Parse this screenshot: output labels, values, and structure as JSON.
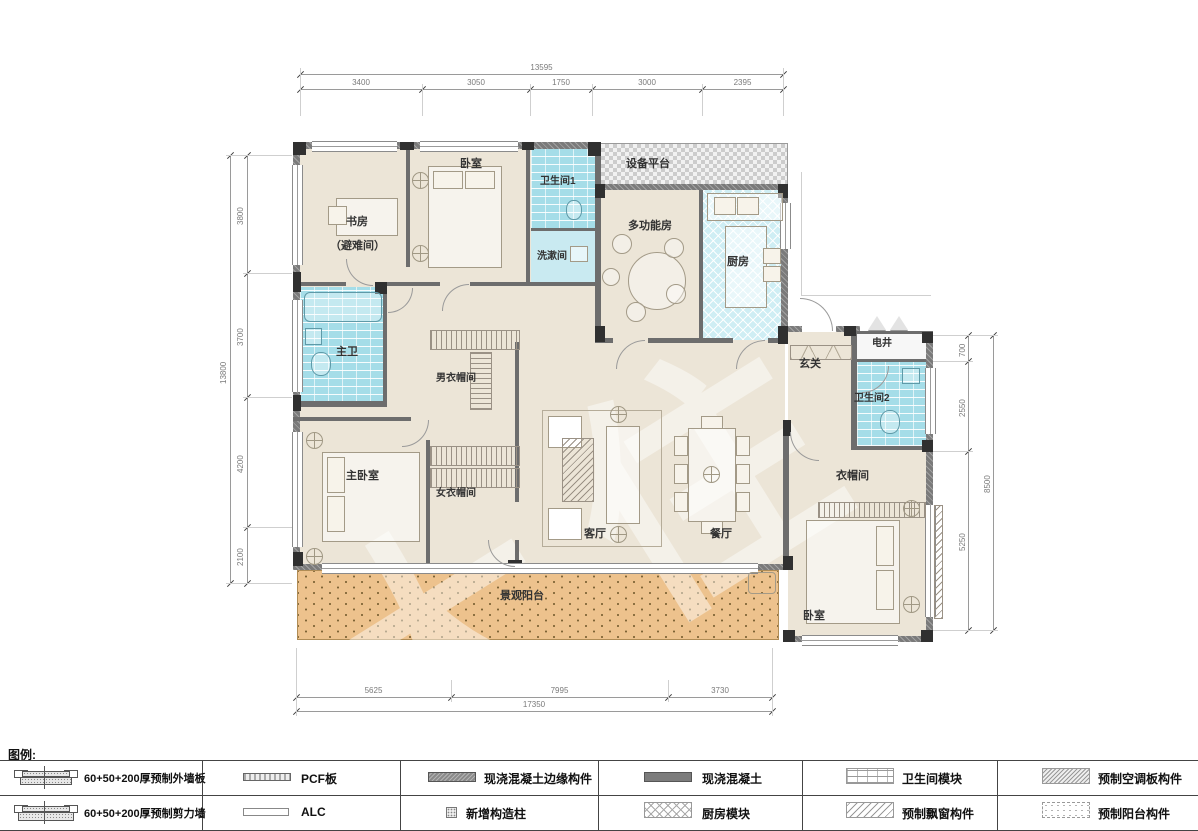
{
  "plan": {
    "watermark": "大住",
    "rooms": [
      {
        "id": "study",
        "label": "书房",
        "sublabel": "（避难间）"
      },
      {
        "id": "bedroom-top",
        "label": "卧室"
      },
      {
        "id": "bath-1",
        "label": "卫生间1"
      },
      {
        "id": "washroom",
        "label": "洗漱间"
      },
      {
        "id": "equipment-platform",
        "label": "设备平台"
      },
      {
        "id": "multifunction-room",
        "label": "多功能房"
      },
      {
        "id": "kitchen",
        "label": "厨房"
      },
      {
        "id": "master-bath",
        "label": "主卫"
      },
      {
        "id": "mens-closet",
        "label": "男衣帽间"
      },
      {
        "id": "master-bedroom",
        "label": "主卧室"
      },
      {
        "id": "womens-closet",
        "label": "女衣帽间"
      },
      {
        "id": "living-room",
        "label": "客厅"
      },
      {
        "id": "dining-room",
        "label": "餐厅"
      },
      {
        "id": "foyer",
        "label": "玄关"
      },
      {
        "id": "electric-shaft",
        "label": "电井"
      },
      {
        "id": "bath-2",
        "label": "卫生间2"
      },
      {
        "id": "closet",
        "label": "衣帽间"
      },
      {
        "id": "bedroom-br",
        "label": "卧室"
      },
      {
        "id": "balcony",
        "label": "景观阳台"
      }
    ],
    "dims": {
      "top": {
        "overall": "13595",
        "segments": [
          "3400",
          "3050",
          "1750",
          "3000",
          "2395"
        ]
      },
      "left": {
        "overall": "13800",
        "segments": [
          "3800",
          "3700",
          "4200",
          "2100"
        ]
      },
      "right": {
        "overall": "8500",
        "segments": [
          "700",
          "2550",
          "5250"
        ]
      },
      "bottom": {
        "overall": "17350",
        "segments": [
          "5625",
          "7995",
          "3730"
        ]
      }
    },
    "colors": {
      "floor": "#ece5d7",
      "bath_module": "#a5dde8",
      "kitchen_module": "#cfeef4",
      "balcony": "#edc28d",
      "wall": "#6d6d6d",
      "concrete_column": "#303030"
    }
  },
  "legend": {
    "title": "图例:",
    "items": [
      {
        "symbol": "precast-exterior-wall",
        "label": "60+50+200厚预制外墙板"
      },
      {
        "symbol": "precast-shear-wall",
        "label": "60+50+200厚预制剪力墙"
      },
      {
        "symbol": "pcf-panel",
        "label": "PCF板"
      },
      {
        "symbol": "alc-panel",
        "label": "ALC"
      },
      {
        "symbol": "cast-in-place-edge",
        "label": "现浇混凝土边缘构件"
      },
      {
        "symbol": "new-structural-column",
        "label": "新增构造柱"
      },
      {
        "symbol": "cast-in-place-concrete",
        "label": "现浇混凝土"
      },
      {
        "symbol": "kitchen-module",
        "label": "厨房模块"
      },
      {
        "symbol": "bathroom-module",
        "label": "卫生间模块"
      },
      {
        "symbol": "precast-bay-window",
        "label": "预制飘窗构件"
      },
      {
        "symbol": "precast-ac-panel",
        "label": "预制空调板构件"
      },
      {
        "symbol": "precast-balcony",
        "label": "预制阳台构件"
      }
    ]
  }
}
